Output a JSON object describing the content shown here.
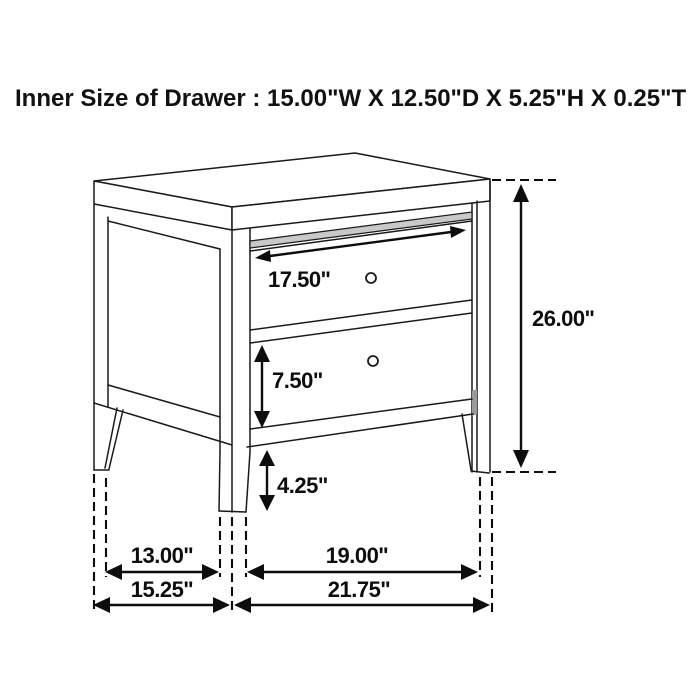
{
  "title": "Inner Size of Drawer : 15.00\"W X 12.50\"D X 5.25\"H X 0.25\"T",
  "diagram": {
    "subject": "two-drawer nightstand dimension drawing",
    "colors": {
      "line": "#1a1a1a",
      "annotation": "#0d0d0d",
      "background": "#ffffff",
      "hatch_fill": "#c9c9c9"
    },
    "labels": {
      "top_drawer_width": "17.50\"",
      "overall_height": "26.00\"",
      "bottom_drawer_height": "7.50\"",
      "floor_clearance": "4.25\"",
      "side_leg_spacing": "13.00\"",
      "front_leg_spacing": "19.00\"",
      "overall_depth": "15.25\"",
      "overall_width": "21.75\""
    }
  }
}
